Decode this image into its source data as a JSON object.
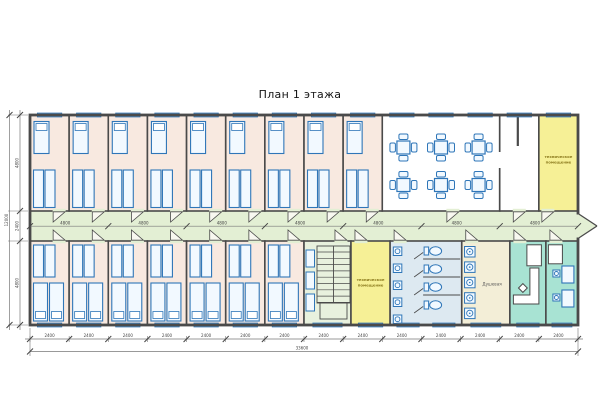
{
  "title": "План 1 этажа",
  "plan": {
    "colors": {
      "wall": "#4a4a4a",
      "bedroom_floor": "#f8e9e0",
      "corridor_floor": "#e3efd4",
      "dining_floor": "#ffffff",
      "tech_floor": "#f6f096",
      "wc_floor": "#dde9f1",
      "shower_floor": "#f3eed7",
      "office_floor": "#a8e3d3",
      "stair_floor": "#e8f1de",
      "fixture": "#2f76b8",
      "fixture_fill": "#f2f9ff",
      "window_fill": "#dff0fb",
      "door_fill": "#f8f8f0",
      "dim_line": "#777777",
      "dim_text": "#444444",
      "tech_text": "#8c7b1e",
      "room_text": "#555555"
    },
    "labels": {
      "tech_room": [
        "техническое",
        "помещение"
      ],
      "shower_room": "Душевая"
    },
    "dimensions": {
      "left_segments": [
        "4800",
        "2400",
        "4800"
      ],
      "left_total": "12000",
      "corridor_segments": [
        "4800",
        "4800",
        "4800",
        "4800",
        "4800",
        "4800",
        "4800"
      ],
      "bottom_segments": [
        "2400",
        "2400",
        "2400",
        "2400",
        "2400",
        "2400",
        "2400",
        "2400",
        "2400",
        "2400",
        "2400",
        "2400",
        "2400",
        "2400"
      ],
      "bottom_total": "33600"
    },
    "top_row": [
      {
        "type": "bedroom",
        "bays": 1
      },
      {
        "type": "bedroom",
        "bays": 1
      },
      {
        "type": "bedroom",
        "bays": 1
      },
      {
        "type": "bedroom",
        "bays": 1
      },
      {
        "type": "bedroom",
        "bays": 1
      },
      {
        "type": "bedroom",
        "bays": 1
      },
      {
        "type": "bedroom",
        "bays": 1
      },
      {
        "type": "bedroom",
        "bays": 1
      },
      {
        "type": "bedroom",
        "bays": 1
      },
      {
        "type": "dining",
        "bays": 3
      },
      {
        "type": "hall",
        "bays": 1
      },
      {
        "type": "tech",
        "bays": 1,
        "label_key": "tech_room"
      }
    ],
    "bottom_row": [
      {
        "type": "bedroom",
        "bays": 1
      },
      {
        "type": "bedroom",
        "bays": 1
      },
      {
        "type": "bedroom",
        "bays": 1
      },
      {
        "type": "bedroom",
        "bays": 1
      },
      {
        "type": "bedroom",
        "bays": 1
      },
      {
        "type": "bedroom",
        "bays": 1
      },
      {
        "type": "bedroom",
        "bays": 1
      },
      {
        "type": "stair",
        "bays": 1.2
      },
      {
        "type": "tech",
        "bays": 1,
        "label_key": "tech_room"
      },
      {
        "type": "wc",
        "bays": 1.83
      },
      {
        "type": "shower",
        "bays": 1.23,
        "label_key": "shower_room"
      },
      {
        "type": "office-l",
        "bays": 0.92
      },
      {
        "type": "office-desks",
        "bays": 0.82
      }
    ]
  }
}
